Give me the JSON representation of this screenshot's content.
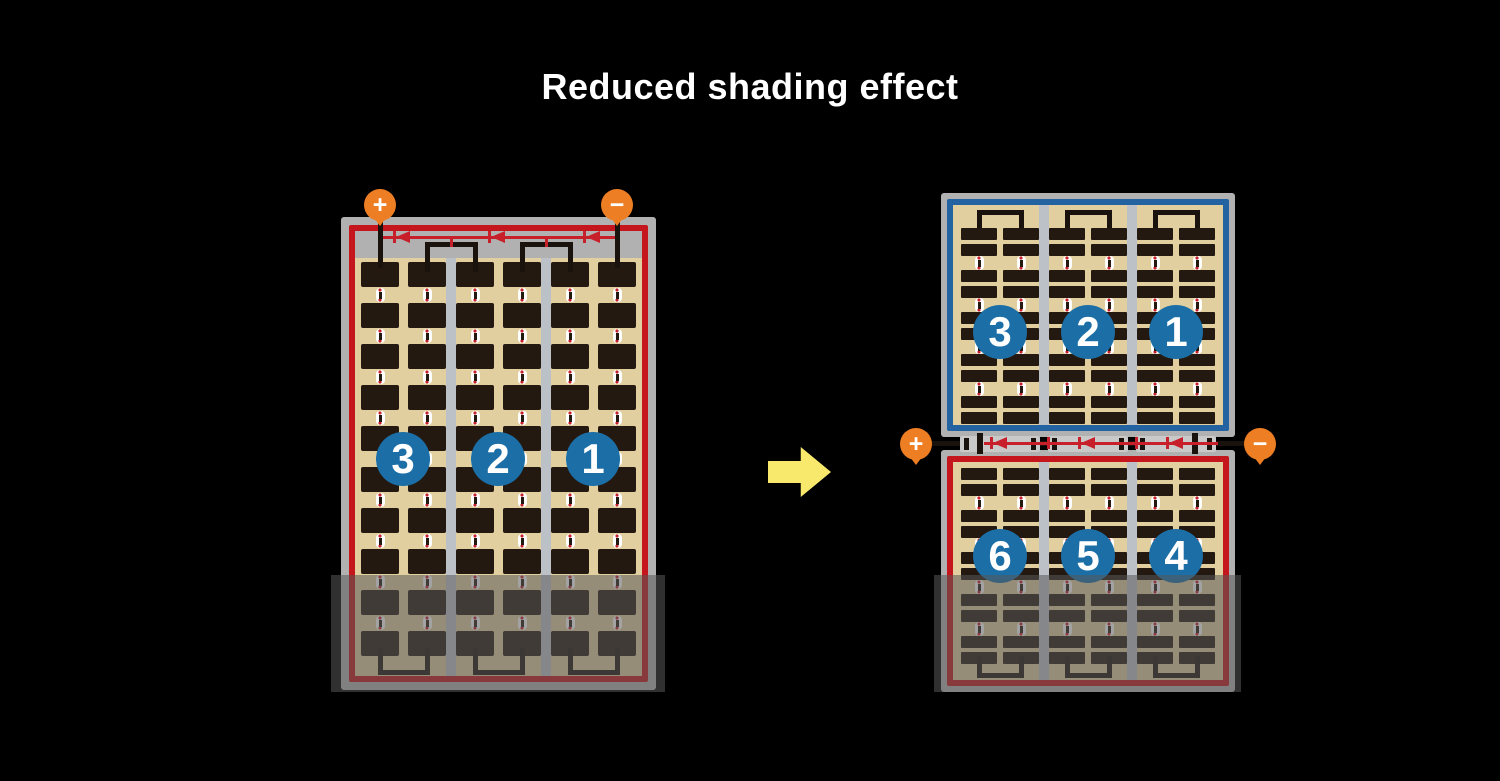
{
  "title": "Reduced shading effect",
  "panels": {
    "full_cell_panel": {
      "terminals": {
        "positive": "+",
        "negative": "−"
      },
      "string_labels": [
        "3",
        "2",
        "1"
      ],
      "cell_rows": 10,
      "cell_columns": 6,
      "strings": 3,
      "bypass_diodes": 3
    },
    "half_cut_panel": {
      "terminals": {
        "positive": "+",
        "negative": "−"
      },
      "top_string_labels": [
        "3",
        "2",
        "1"
      ],
      "bottom_string_labels": [
        "6",
        "5",
        "4"
      ],
      "bar_rows_per_half": 10,
      "cell_columns": 6,
      "strings": 6,
      "bypass_diodes": 3
    }
  },
  "colors": {
    "background": "#000000",
    "title_text": "#FFFFFF",
    "terminal_orange": "#EE7E23",
    "frame_gray": "#B1B1B1",
    "cell_tan": "#E2CF9F",
    "cell_dark": "#241911",
    "divider_gray": "#BCC0C7",
    "border_red": "#C4161C",
    "border_blue": "#2363A2",
    "diode_red": "#C8202A",
    "badge_blue": "#1B6EA6",
    "badge_text": "#FFFFFF",
    "wire_black": "#1A120C",
    "junction_gray": "#C9C9C9",
    "arrow_yellow": "#F8E96D",
    "shade": "rgba(88,88,88,0.55)"
  }
}
